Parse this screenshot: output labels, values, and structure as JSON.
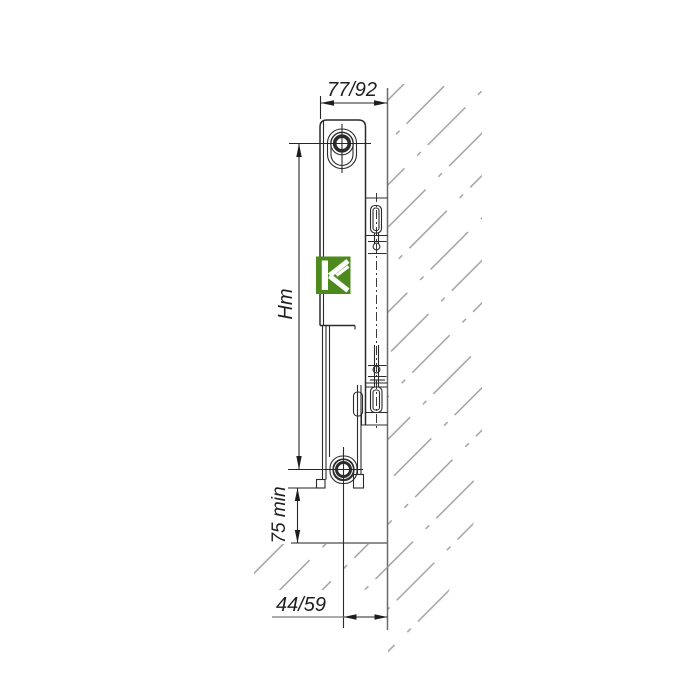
{
  "drawing": {
    "type": "radiator side-view wall-mounting technical diagram",
    "labels": {
      "depth_top": "77/92",
      "height": "Hm",
      "floor_clearance": "75 min",
      "wall_offset_bottom": "44/59"
    },
    "logo": {
      "letter": "K",
      "background_color": "#4c8a1e",
      "glyph_color": "#ffffff"
    },
    "colors": {
      "background": "#ffffff",
      "outline": "#2b2b2b",
      "wall": "#6a6a6a",
      "hatch": "#9b9b9b"
    }
  }
}
